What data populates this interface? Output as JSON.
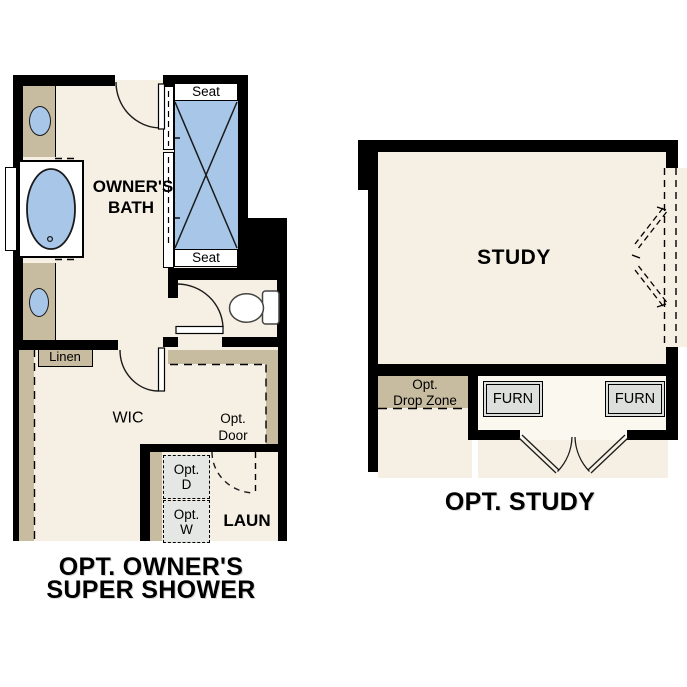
{
  "left_plan": {
    "room_labels": {
      "owners_bath": [
        "OWNER'S",
        "BATH"
      ],
      "wic": "WIC",
      "laundry": "LAUN"
    },
    "fixture_labels": {
      "seat_top": "Seat",
      "seat_bottom": "Seat",
      "linen": "Linen",
      "opt_door": [
        "Opt.",
        "Door"
      ],
      "opt_dryer": [
        "Opt.",
        "D"
      ],
      "opt_washer": [
        "Opt.",
        "W"
      ]
    },
    "caption": [
      "OPT. OWNER'S",
      "SUPER SHOWER"
    ]
  },
  "right_plan": {
    "room_labels": {
      "study": "STUDY"
    },
    "fixture_labels": {
      "drop_zone": [
        "Opt.",
        "Drop Zone"
      ],
      "furnace_left": "FURN",
      "furnace_right": "FURN"
    },
    "caption": "OPT. STUDY"
  },
  "colors": {
    "wall": "#000000",
    "floor": "#f6efe3",
    "casework_tan": "#c7bba0",
    "fixture_blue": "#a7c6e8",
    "appliance_gray": "#e4e7e4",
    "furnace_gray": "#dcdfdc",
    "fixture_white": "#ffffff",
    "text": "#000000"
  }
}
